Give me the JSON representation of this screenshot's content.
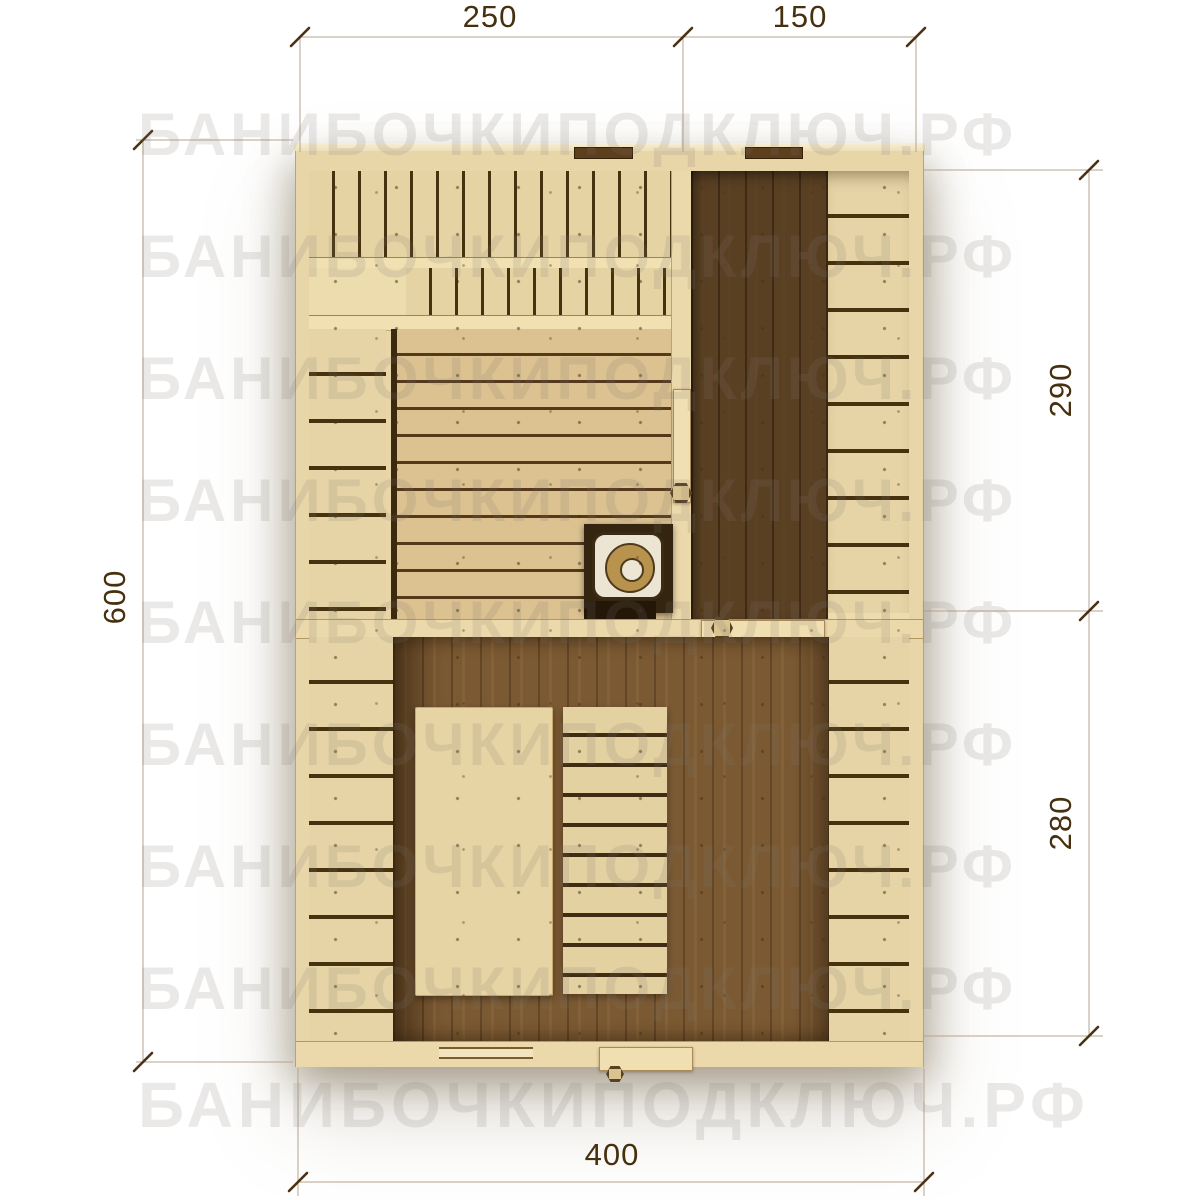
{
  "watermark": {
    "text": "БАНИБОЧКИПОДКЛЮЧ.РФ"
  },
  "dimensions": {
    "top_left": "250",
    "top_right": "150",
    "right_upper": "290",
    "right_lower": "280",
    "left_side": "600",
    "bottom": "400"
  },
  "plan": {
    "type": "sauna-floor-plan-top-view",
    "elements": [
      "two-tier-slatted-bench",
      "side-bench",
      "lounger-platform",
      "stove-with-chimney",
      "washroom-dark-floor",
      "wall-bench",
      "rest-room-floor",
      "table",
      "slatted-bench",
      "interior-door-sauna",
      "interior-door-washroom",
      "entrance-door",
      "wall-vents",
      "window"
    ]
  },
  "colors": {
    "background": "#ffffff",
    "watermark": "#e9e9e9",
    "wood_light": "#e7d4a6",
    "wood_rail": "#f0e0b2",
    "slat_gap": "#46320f",
    "floor_washroom": "#5a4023",
    "floor_restroom": "#7b5a33",
    "stove_frame": "#33250f",
    "stove_top": "#ece5d4",
    "stove_ring": "#b8934e",
    "dimension_line": "#b5a48e",
    "dimension_text": "#46300f"
  }
}
